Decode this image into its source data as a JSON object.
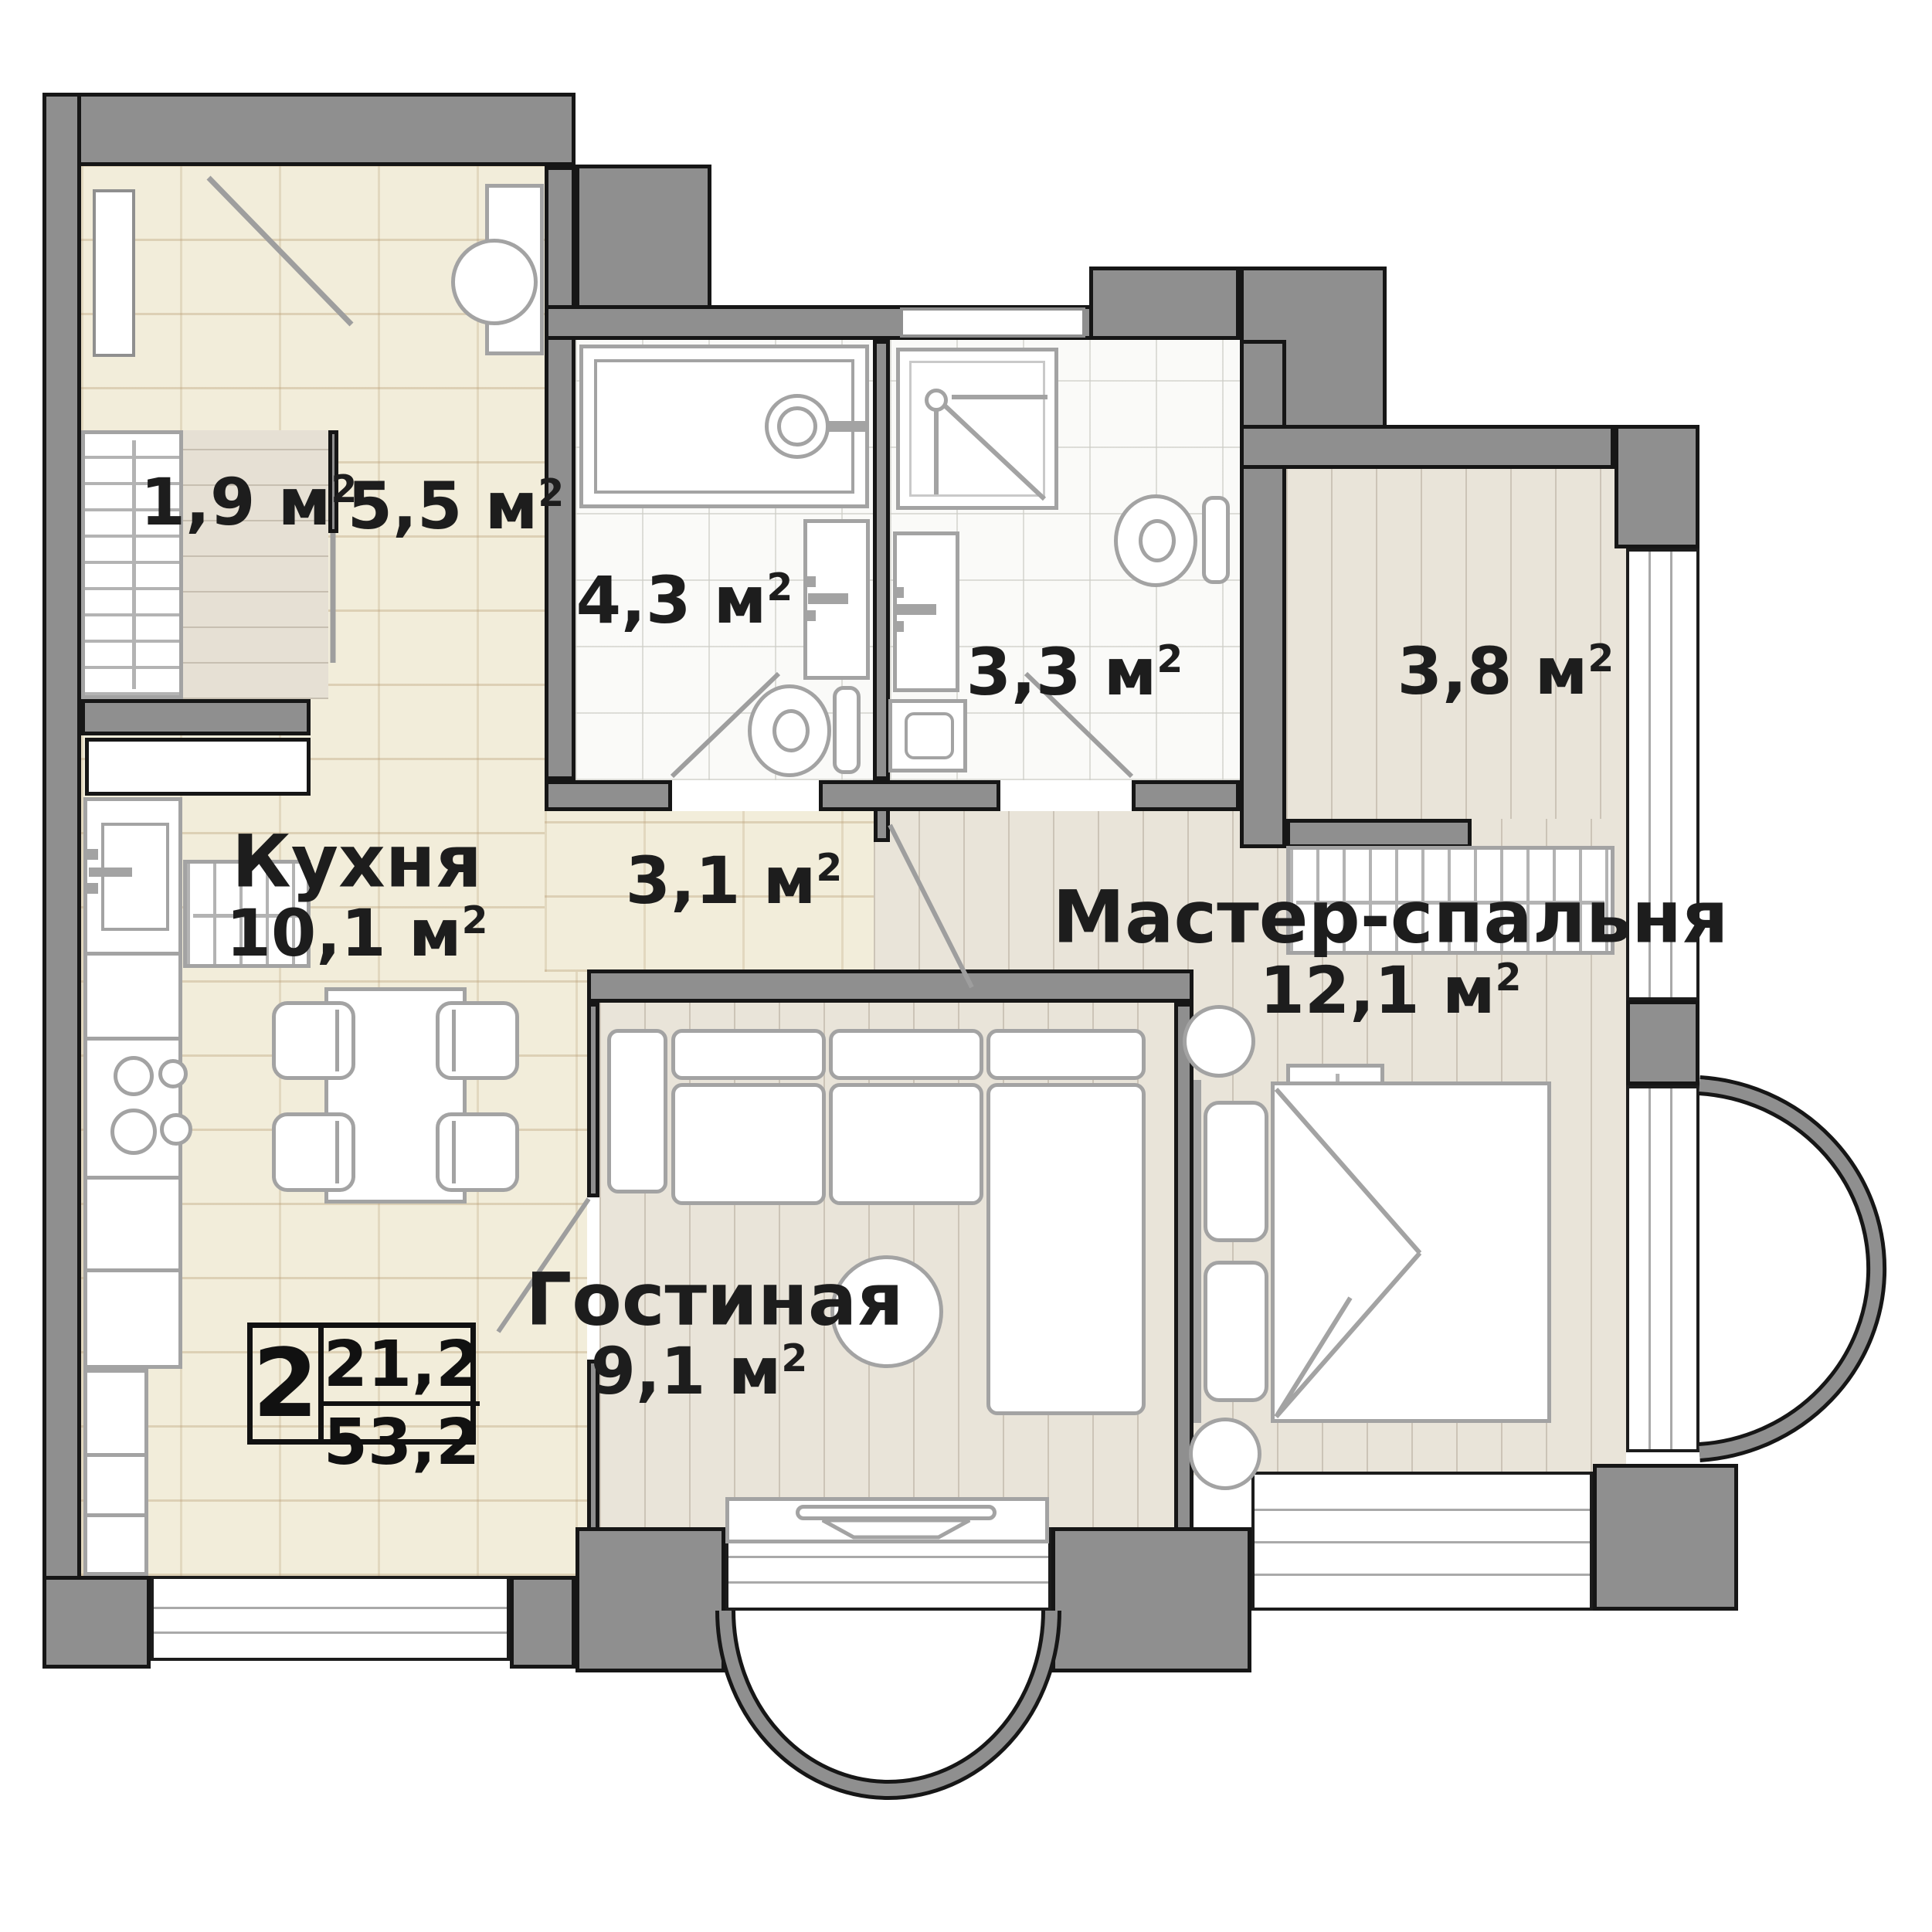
{
  "meta": {
    "type": "apartment-floor-plan",
    "unit": "м",
    "sup": "2",
    "colors": {
      "wall": "#8f8f8f",
      "wall_outline": "#161616",
      "text": "#1d1d1d",
      "tile_floor": "#f2edda",
      "wood_floor": "#e9e4d9",
      "bath_floor": "#fafaf8",
      "furniture_line": "#a3a3a3"
    }
  },
  "badge": {
    "rooms": "2",
    "living_area": "21,2",
    "total_area": "53,2"
  },
  "rooms": {
    "entry_closet": {
      "area": "1,9"
    },
    "hallway": {
      "area": "5,5"
    },
    "bathroom_big": {
      "area": "4,3"
    },
    "bathroom_small": {
      "area": "3,3"
    },
    "wardrobe": {
      "area": "3,8"
    },
    "kitchen": {
      "name": "Кухня",
      "area": "10,1"
    },
    "corridor": {
      "area": "3,1"
    },
    "master_bedroom": {
      "name": "Мастер-спальня",
      "area": "12,1"
    },
    "living_room": {
      "name": "Гостиная",
      "area": "9,1"
    }
  },
  "icons": {
    "bathtub": "rect-with-faucet-circle",
    "shower": "square-with-diagonal-and-drain",
    "toilet": "tank-and-bowl",
    "sink_vanity": "rect-with-basin",
    "water_heater": "rect-with-circle",
    "stove": "four-burner-circles",
    "kitchen_sink": "square-with-faucet",
    "dining_table": "rect-with-4-chairs",
    "sofa": "l-shaped-sectional",
    "coffee_table": "circle",
    "tv_stand": "long-rect-with-tv",
    "bed": "rect-with-fold-lines-and-pillows",
    "nightstand": "circle",
    "wardrobe_rail": "hatched-rect",
    "door_swing": "diagonal-line",
    "window": "striped-strip",
    "bay_window": "semicircular-arc"
  }
}
